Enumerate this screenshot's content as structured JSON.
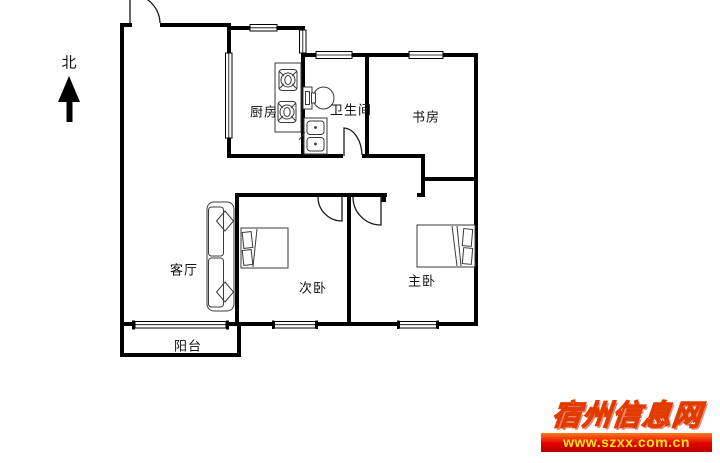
{
  "compass": {
    "north_label": "北"
  },
  "rooms": {
    "kitchen": {
      "label": "厨房"
    },
    "bathroom": {
      "label": "卫生间"
    },
    "study": {
      "label": "书房"
    },
    "living_room": {
      "label": "客厅"
    },
    "second_bedroom": {
      "label": "次卧"
    },
    "master_bedroom": {
      "label": "主卧"
    },
    "balcony": {
      "label": "阳台"
    }
  },
  "watermark": {
    "site_name": "宿州信息网",
    "url": "www.szxx.com.cn",
    "name_color": "#ffd21e",
    "name_outline_color": "#e23b00",
    "bar_text_color": "#ffe70f",
    "bar_gradient_top": "#ff7a1a",
    "bar_gradient_bottom": "#b80000"
  },
  "floorplan_style": {
    "wall_color": "#000000",
    "furniture_line_color": "#3a3a3a",
    "label_color": "#111111",
    "background_color": "#ffffff"
  }
}
